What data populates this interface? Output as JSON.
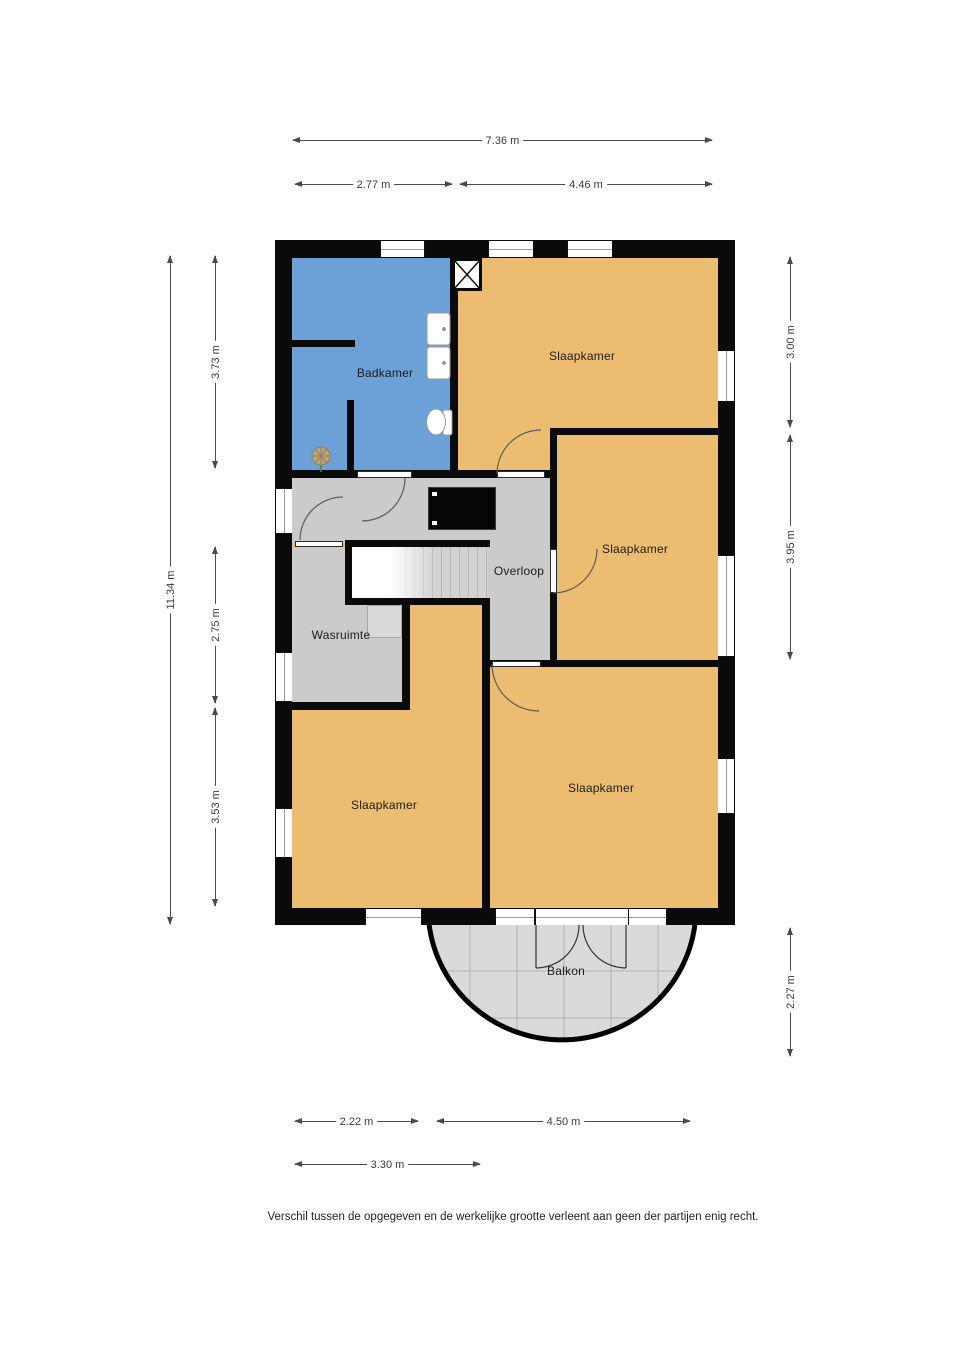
{
  "plan": {
    "rooms": {
      "badkamer": "Badkamer",
      "slaapkamer_top": "Slaapkamer",
      "slaapkamer_mid": "Slaapkamer",
      "slaapkamer_bottom_left": "Slaapkamer",
      "slaapkamer_bottom_right": "Slaapkamer",
      "overloop": "Overloop",
      "wasruimte": "Wasruimte",
      "balkon": "Balkon"
    },
    "dimensions": {
      "top_total": "7.36 m",
      "top_left": "2.77 m",
      "top_right": "4.46 m",
      "left_total": "11.34 m",
      "left_upper": "3.73 m",
      "left_middle": "2.75 m",
      "left_lower": "3.53 m",
      "right_upper": "3.00 m",
      "right_middle": "3.95 m",
      "right_balkon": "2.27 m",
      "bottom_left": "2.22 m",
      "bottom_right": "4.50 m",
      "bottom_lower": "3.30 m"
    },
    "disclaimer": "Verschil tussen de opgegeven en de werkelijke grootte verleent aan geen der partijen enig recht.",
    "colors": {
      "wall": "#0a0a0a",
      "bedroom_fill": "#ecbd71",
      "bathroom_fill": "#6ba1d6",
      "hall_fill": "#cbcbcb",
      "balcony_fill": "#dadada"
    }
  }
}
